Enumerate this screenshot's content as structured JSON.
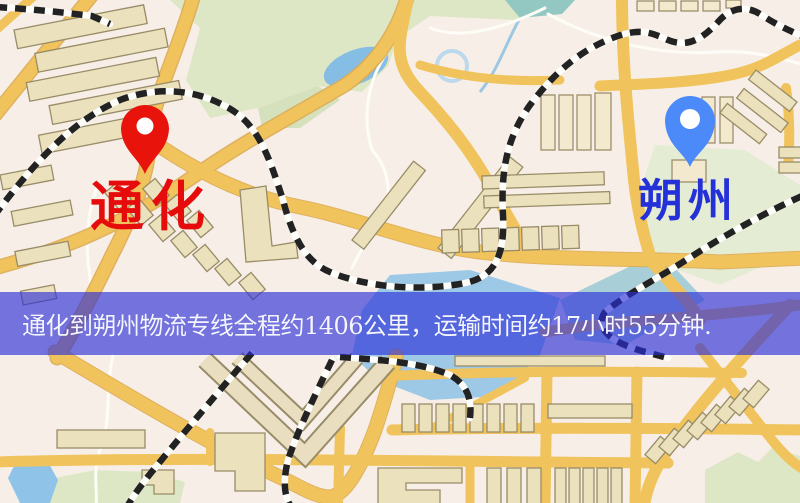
{
  "map": {
    "origin_marker": {
      "label": "通化",
      "pin_color": "#e8140c",
      "label_color": "#e70c0c"
    },
    "destination_marker": {
      "label": "朔州",
      "pin_color": "#4b8af8",
      "label_color": "#2531d8"
    },
    "banner": {
      "text": "通化到朔州物流专线全程约1406公里，运输时间约17小时55分钟.",
      "route": "通化到朔州",
      "service": "物流专线",
      "distance": "约1406公里",
      "duration": "约17小时55分钟",
      "text_color": "#f4f6fc",
      "background_color": "rgba(42,46,218,0.64)"
    },
    "colors": {
      "map_background": "#f7efe7",
      "park_green": "#dde7c6",
      "water_blue": "#8fc3e8",
      "road_yellow": "#f0c35c",
      "building_tan": "#ece1bd"
    }
  }
}
